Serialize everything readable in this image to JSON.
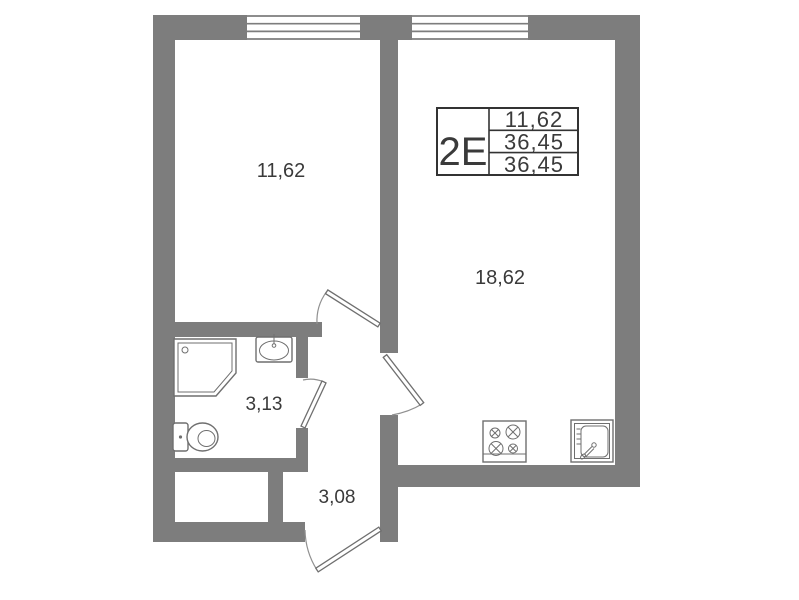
{
  "floor_plan": {
    "info_box": {
      "apartment_type": "2Е",
      "values": [
        "11,62",
        "36,45",
        "36,45"
      ]
    },
    "room_labels": {
      "living_room": "11,62",
      "kitchen_living_room": "18,62",
      "bathroom": "3,13",
      "hallway": "3,08"
    },
    "fixtures": [
      "shower-tray-icon",
      "washbasin-icon",
      "toilet-icon",
      "stove-icon",
      "kitchen-sink-icon"
    ],
    "windows_count": 2,
    "doors_count": 4,
    "colors": {
      "wall": "#7d7d7d",
      "fixture_line": "#6f6f6f",
      "text": "#3a3a3a",
      "background": "#ffffff"
    }
  }
}
